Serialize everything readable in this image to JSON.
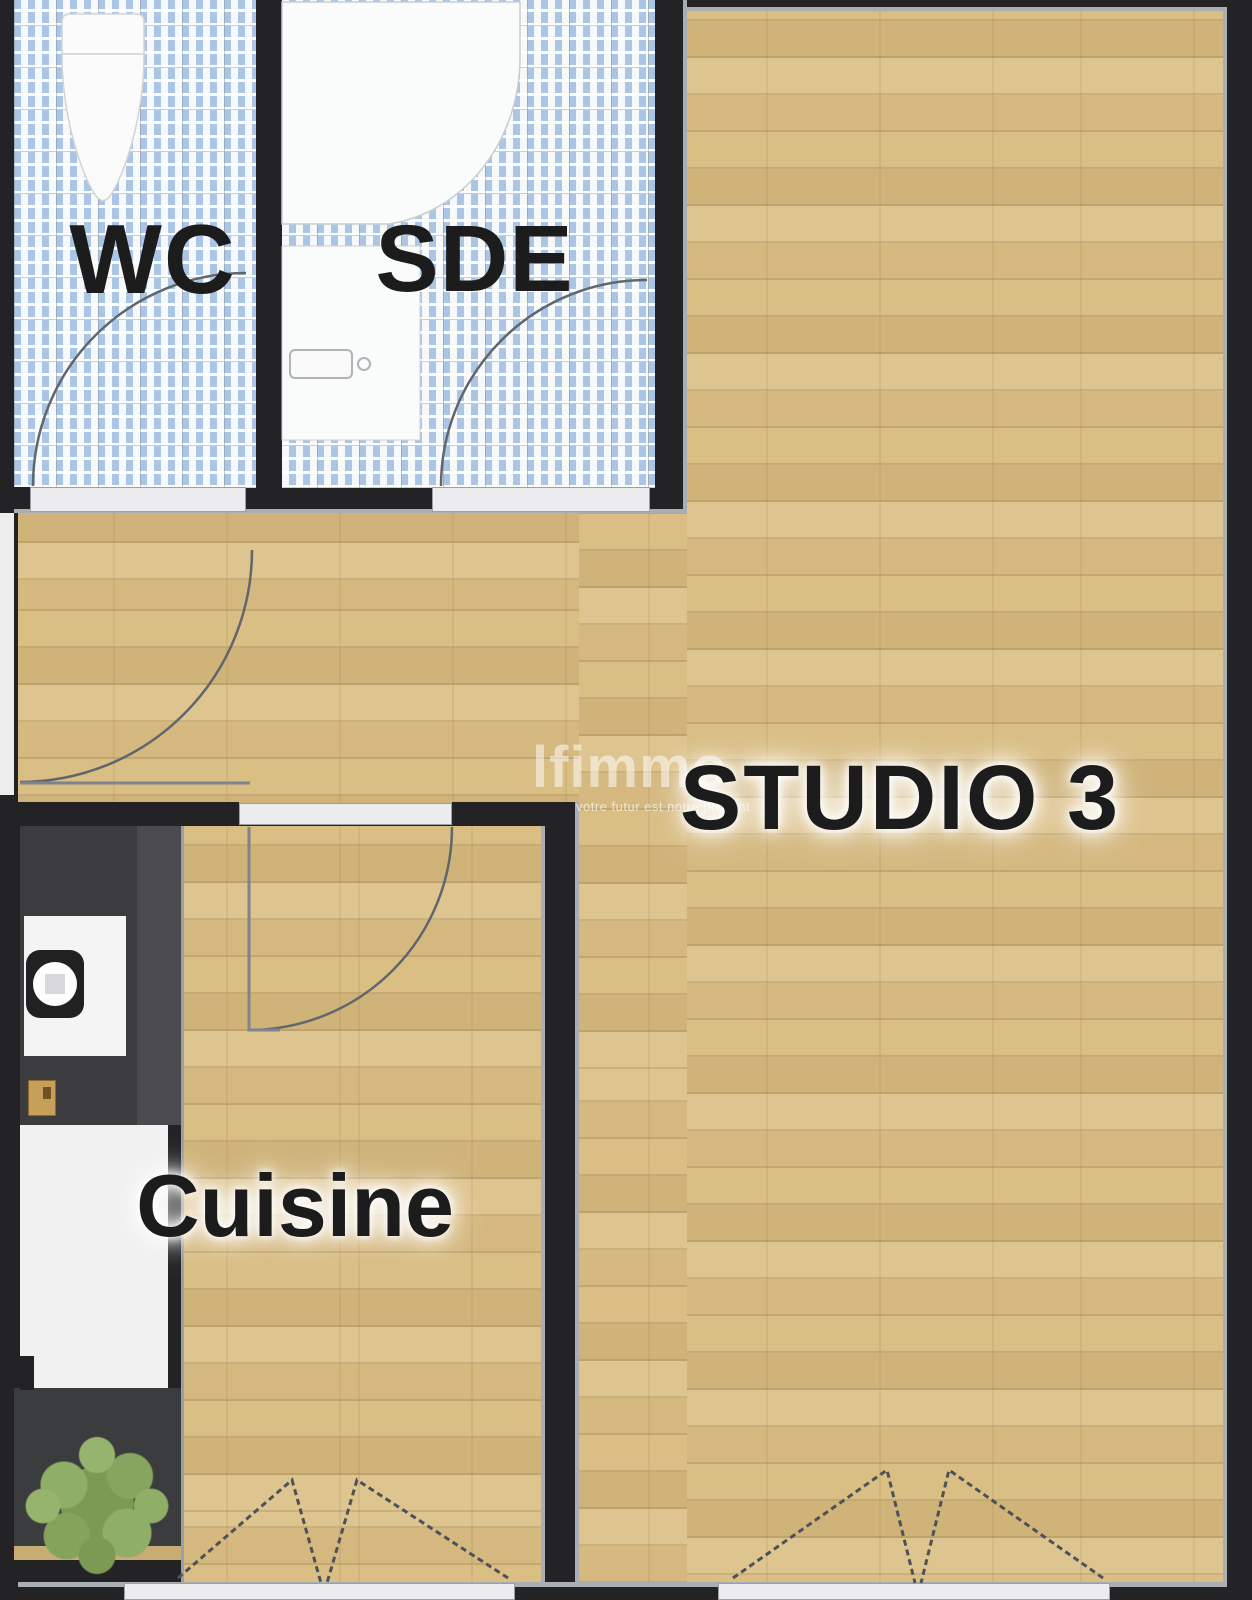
{
  "plan": {
    "type": "floor-plan",
    "rooms": [
      {
        "id": "wc",
        "label": "WC"
      },
      {
        "id": "sde",
        "label": "SDE"
      },
      {
        "id": "studio",
        "label": "STUDIO 3"
      },
      {
        "id": "cuisine",
        "label": "Cuisine"
      }
    ],
    "watermark": {
      "brand": "lfimmo",
      "tagline": "votre futur est notre présent"
    },
    "colors": {
      "wall": "#232325",
      "wood_floor": "#d8bc82",
      "tile_blue": "#abc6e4",
      "counter_dark": "#3f3f42",
      "balcony_dark": "#3b3c3e",
      "plant_green": "#85a159",
      "door_line": "#565b61",
      "label_text": "#1c1c1c",
      "fixture_white": "#fafbfb"
    }
  }
}
